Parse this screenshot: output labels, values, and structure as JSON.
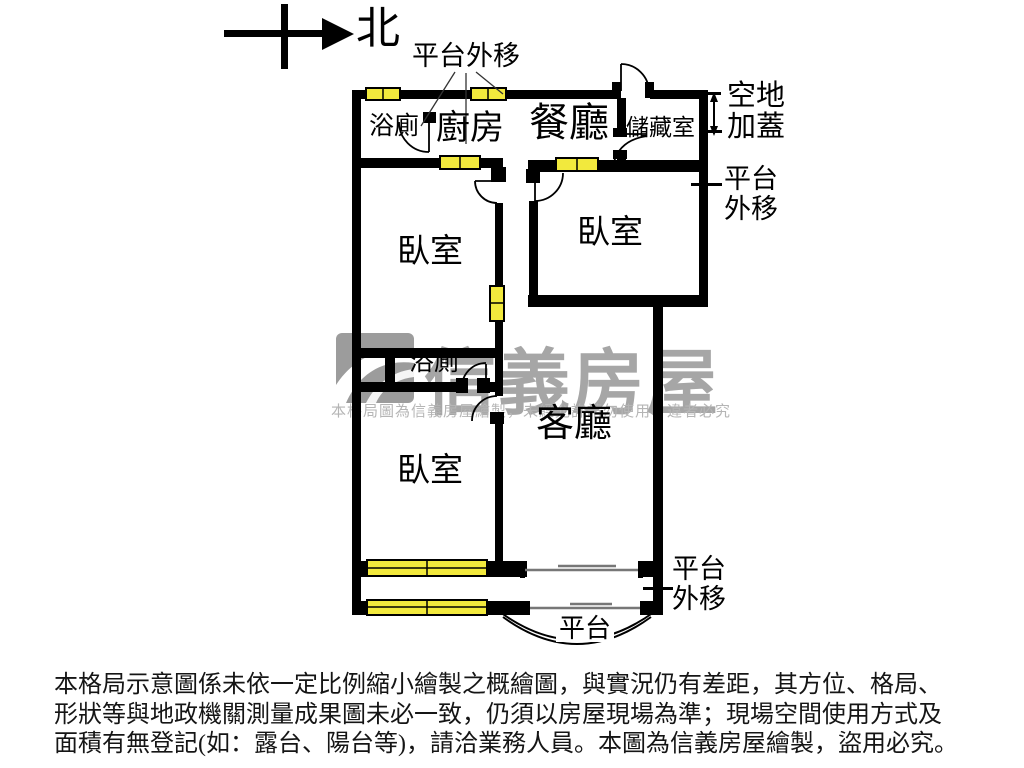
{
  "compass": {
    "north_label": "北"
  },
  "annotations": {
    "platform_moved_top": "平台外移",
    "open_land_addition": [
      "空地",
      "加蓋"
    ],
    "platform_moved_right": [
      "平台",
      "外移"
    ],
    "platform_moved_bottom_right": [
      "平台",
      "外移"
    ],
    "platform_curve_label": "平台"
  },
  "rooms": {
    "bath_top": "浴廁",
    "kitchen": "廚房",
    "dining": "餐廳",
    "storage": "儲藏室",
    "bedroom_right": "臥室",
    "bedroom_middle": "臥室",
    "bath_middle": "浴廁",
    "living": "客廳",
    "bedroom_bottom": "臥室"
  },
  "watermark": {
    "brand": "信義房屋",
    "notice": "本格局圖為信義房屋繪製，未經允許請勿使用，違者必究"
  },
  "disclaimer": {
    "line1": "本格局示意圖係未依一定比例縮小繪製之概繪圖，與實況仍有差距，其方位、格局、",
    "line2": "形狀等與地政機關測量成果圖未必一致，仍須以房屋現場為準；現場空間使用方式及",
    "line3": "面積有無登記(如：露台、陽台等)，請洽業務人員。本圖為信義房屋繪製，盜用必究。"
  },
  "colors": {
    "wall": "#000000",
    "window_fill": "#f2e93d",
    "watermark_gray": "#a6a6a6",
    "background": "#ffffff"
  }
}
